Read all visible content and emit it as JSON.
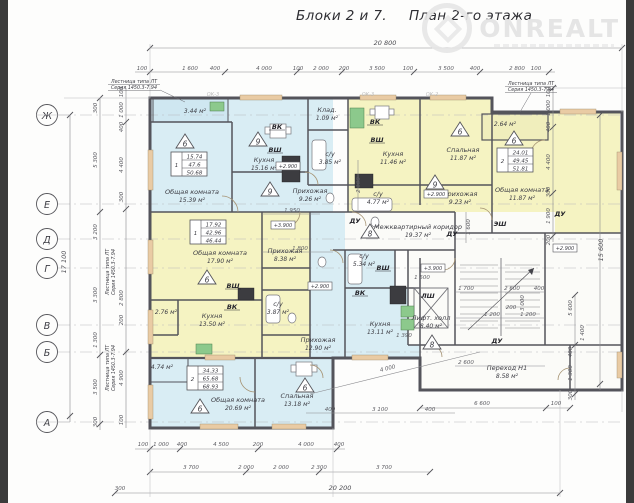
{
  "title": {
    "part1": "Блоки 2 и 7.",
    "part2": "План 2-го этажа"
  },
  "watermark": {
    "brand": "ONREALT"
  },
  "grid_rows": [
    "Ж",
    "Е",
    "Д",
    "Г",
    "В",
    "Б",
    "А"
  ],
  "window_tags": [
    "ОК-3",
    "ОК-3",
    "ОК-2"
  ],
  "note": {
    "line1": "Лестница типа ЛТ",
    "line2": "Серия 1450.3-7.94"
  },
  "apartments": [
    {
      "rooms_count": "1",
      "living_area": "15.74",
      "useful_area": "47.6",
      "total_area": "50.68"
    },
    {
      "rooms_count": "1",
      "living_area": "17.92",
      "useful_area": "42.96",
      "total_area": "46.44"
    },
    {
      "rooms_count": "2",
      "living_area": "24.01",
      "useful_area": "49.45",
      "total_area": "51.81"
    },
    {
      "rooms_count": "2",
      "living_area": "34.33",
      "useful_area": "65.68",
      "total_area": "68.93"
    }
  ],
  "rooms": {
    "a_loggia_area": "3.44 м²",
    "a_living": {
      "name": "Общая комната",
      "area": "15.39 м²"
    },
    "a_kitchen": {
      "name": "Кухня",
      "area": "15.16 м²"
    },
    "a_hall": {
      "name": "Прихожая",
      "area": "9.26 м²"
    },
    "a_wc": {
      "name": "с/у",
      "area": "3.85 м²"
    },
    "a_storage": {
      "name": "Клад.",
      "area": "1.09 м²"
    },
    "b_kitchen": {
      "name": "Кухня",
      "area": "11.46 м²"
    },
    "b_wc": {
      "name": "с/у",
      "area": "4.77 м²"
    },
    "b_bedroom": {
      "name": "Спальная",
      "area": "11.87 м²"
    },
    "b_hall": {
      "name": "Прихожая",
      "area": "9.23 м²"
    },
    "c_loggia_area": "2.64 м²",
    "c_living": {
      "name": "Общая комната",
      "area": "11.87 м²"
    },
    "corridor": {
      "name": "Межквартирный коридор",
      "area": "19.37 м²"
    },
    "d_living": {
      "name": "Общая комната",
      "area": "17.90 м²"
    },
    "d_kitchen": {
      "name": "Кухня",
      "area": "13.50 м²"
    },
    "d_hall": {
      "name": "Прихожая",
      "area": "8.38 м²"
    },
    "d_wc": {
      "name": "с/у",
      "area": "3.87 м²"
    },
    "d_storage_area": "2.76 м²",
    "e_living": {
      "name": "Общая комната",
      "area": "20.69 м²"
    },
    "e_bedroom": {
      "name": "Спальная",
      "area": "13.18 м²"
    },
    "e_kitchen": {
      "name": "Кухня",
      "area": "13.11 м²"
    },
    "e_hall": {
      "name": "Прихожая",
      "area": "12.90 м²"
    },
    "e_wc": {
      "name": "с/у",
      "area": "5.34 м²"
    },
    "e_storage_area": "4.74 м²",
    "lift_hall": {
      "name": "Лифт. холл",
      "area": "8.40 м²"
    },
    "passage": {
      "name": "Переход Н1",
      "area": "8.58 м²"
    }
  },
  "badges": [
    "6",
    "9",
    "9",
    "6",
    "9",
    "6",
    "6",
    "8",
    "8",
    "6",
    "6"
  ],
  "labels": {
    "vk": "ВК",
    "vsh": "ВШ",
    "du": "ДУ",
    "esh": "ЭШ",
    "lsh": "ЛШ",
    "elev_29": "+2.900",
    "elev_39": "+3.900"
  },
  "dims": {
    "overall_top": "20 800",
    "overall_bottom": "20 200",
    "overall_left": "17 100",
    "overall_right": "15 600",
    "bottom_offset": "300",
    "top": [
      "100",
      "1 600",
      "400",
      "4 000",
      "100",
      "2 000",
      "200",
      "3 500",
      "100",
      "3 500",
      "400",
      "2 800",
      "100"
    ],
    "bottom1": [
      "100",
      "1 000",
      "400",
      "4 500",
      "200",
      "4 000",
      "400"
    ],
    "bottom2": [
      "3 700",
      "2 000",
      "2 000",
      "2 300",
      "3 700"
    ],
    "passage_bottom": [
      "6 600",
      "100"
    ],
    "left_outer": [
      "300",
      "5 300",
      "3 200",
      "3 300",
      "1 300",
      "3 500",
      "300"
    ],
    "left_inner": [
      "100",
      "1 000",
      "400",
      "4 400",
      "300",
      "2 800",
      "200",
      "4 900",
      "100"
    ],
    "right_inner": [
      "100",
      "1 000",
      "400",
      "4 400",
      "300",
      "1 900",
      "200"
    ],
    "right_lower": [
      "5 600",
      "400",
      "1 300",
      "300"
    ],
    "interior": [
      "2 100",
      "1 950",
      "1 800",
      "1 600",
      "1 700",
      "2 600",
      "400",
      "1 200",
      "200",
      "1 200",
      "2 600",
      "3 000",
      "1 400",
      "1 390",
      "1 500",
      "4 000",
      "3 100",
      "400",
      "400"
    ]
  }
}
